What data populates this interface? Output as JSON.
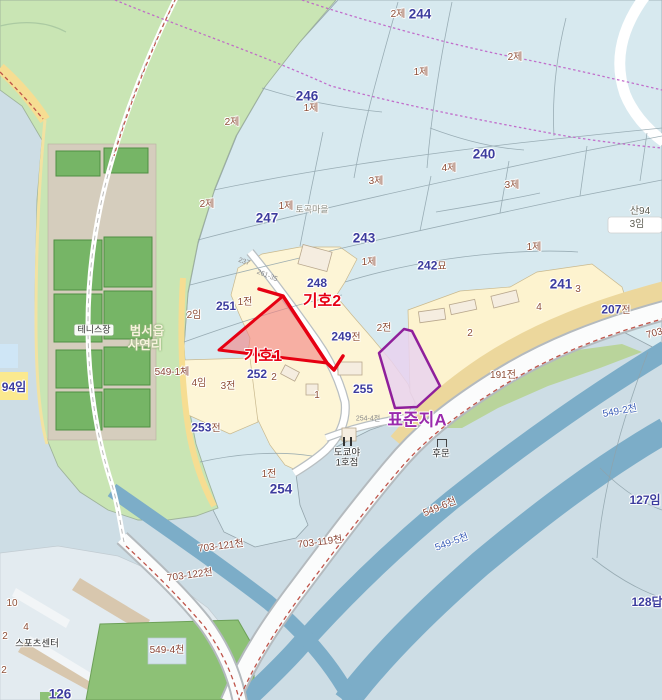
{
  "map": {
    "colors": {
      "base": "#cddde5",
      "cadastral_blue": "#d7e9ef",
      "forest_green": "#c9e5b4",
      "village_cream": "#fdf5d6",
      "river_blue": "#7cadc8",
      "road_yellow": "#f6dd92",
      "subject_red": "#e60012",
      "standard_purple": "#8f1f9b",
      "admin_dotted": "#bf62c8"
    },
    "highlights": {
      "subject1": {
        "label": "기호1",
        "stroke": "#e60012",
        "fill": "#f38080"
      },
      "subject2": {
        "label": "기호2",
        "stroke": "#e60012"
      },
      "standard": {
        "label": "표준지A",
        "stroke": "#8f1f9b",
        "fill": "#e9d2ef"
      }
    },
    "labels": [
      {
        "t": "2제",
        "x": 398,
        "y": 15,
        "c": "cat"
      },
      {
        "t": "244",
        "x": 420,
        "y": 14,
        "c": "pnum lg"
      },
      {
        "t": "2제",
        "x": 515,
        "y": 58,
        "c": "cat"
      },
      {
        "t": "246",
        "x": 307,
        "y": 96,
        "c": "pnum lg"
      },
      {
        "t": "1제",
        "x": 311,
        "y": 109,
        "c": "cat"
      },
      {
        "t": "2제",
        "x": 232,
        "y": 123,
        "c": "cat"
      },
      {
        "t": "1제",
        "x": 421,
        "y": 73,
        "c": "cat"
      },
      {
        "t": "240",
        "x": 484,
        "y": 154,
        "c": "pnum lg"
      },
      {
        "t": "4제",
        "x": 449,
        "y": 169,
        "c": "cat"
      },
      {
        "t": "3제",
        "x": 376,
        "y": 182,
        "c": "cat"
      },
      {
        "t": "3제",
        "x": 512,
        "y": 186,
        "c": "cat"
      },
      {
        "t": "2제",
        "x": 207,
        "y": 205,
        "c": "cat"
      },
      {
        "t": "1제",
        "x": 286,
        "y": 207,
        "c": "cat"
      },
      {
        "t": "토곡마을",
        "x": 312,
        "y": 210,
        "c": "place"
      },
      {
        "t": "247",
        "x": 267,
        "y": 218,
        "c": "pnum lg"
      },
      {
        "t": "243",
        "x": 364,
        "y": 238,
        "c": "pnum lg"
      },
      {
        "t": "1제",
        "x": 369,
        "y": 263,
        "c": "cat"
      },
      {
        "t": "산94",
        "x": 640,
        "y": 212,
        "c": "cat2"
      },
      {
        "t": "3임",
        "x": 637,
        "y": 225,
        "c": "cat2"
      },
      {
        "t": "248",
        "x": 317,
        "y": 283,
        "c": "pnum"
      },
      {
        "t": "242",
        "t2": "묘",
        "x": 432,
        "y": 266,
        "c": "pnum"
      },
      {
        "t": "1제",
        "x": 534,
        "y": 248,
        "c": "cat"
      },
      {
        "t": "241",
        "x": 561,
        "y": 284,
        "c": "pnum lg"
      },
      {
        "t": "3",
        "x": 578,
        "y": 290,
        "c": "num"
      },
      {
        "t": "4",
        "x": 539,
        "y": 308,
        "c": "num"
      },
      {
        "t": "207",
        "t2": "전",
        "x": 616,
        "y": 310,
        "c": "pnum"
      },
      {
        "t": "2",
        "x": 470,
        "y": 334,
        "c": "num"
      },
      {
        "t": "2전",
        "x": 384,
        "y": 329,
        "c": "cat"
      },
      {
        "t": "249",
        "t2": "전",
        "x": 346,
        "y": 337,
        "c": "pnum"
      },
      {
        "t": "251",
        "x": 226,
        "y": 306,
        "c": "pnum"
      },
      {
        "t": "1전",
        "x": 245,
        "y": 303,
        "c": "cat"
      },
      {
        "t": "2임",
        "x": 194,
        "y": 316,
        "c": "cat"
      },
      {
        "t": "252",
        "x": 257,
        "y": 374,
        "c": "pnum"
      },
      {
        "t": "2",
        "x": 274,
        "y": 378,
        "c": "num"
      },
      {
        "t": "4임",
        "x": 199,
        "y": 384,
        "c": "cat"
      },
      {
        "t": "3전",
        "x": 228,
        "y": 387,
        "c": "cat"
      },
      {
        "t": "255",
        "x": 363,
        "y": 389,
        "c": "pnum"
      },
      {
        "t": "1",
        "x": 317,
        "y": 396,
        "c": "num"
      },
      {
        "t": "191전",
        "x": 503,
        "y": 376,
        "c": "cat"
      },
      {
        "t": "253",
        "t2": "전",
        "x": 206,
        "y": 428,
        "c": "pnum"
      },
      {
        "t": "1전",
        "x": 269,
        "y": 475,
        "c": "cat"
      },
      {
        "t": "254",
        "x": 281,
        "y": 489,
        "c": "pnum lg"
      },
      {
        "t": "94임",
        "x": 14,
        "y": 387,
        "c": "pnum"
      },
      {
        "t": "127임",
        "x": 645,
        "y": 500,
        "c": "pnum"
      },
      {
        "t": "128답",
        "x": 647,
        "y": 602,
        "c": "pnum"
      },
      {
        "t": "126",
        "x": 60,
        "y": 694,
        "c": "pnum lg"
      },
      {
        "t": "테니스장",
        "x": 94,
        "y": 330,
        "c": "poibadge"
      },
      {
        "t": "범서읍",
        "x": 147,
        "y": 331,
        "c": "area"
      },
      {
        "t": "사연리",
        "x": 145,
        "y": 345,
        "c": "area"
      },
      {
        "t": "549-1체",
        "x": 172,
        "y": 373,
        "c": "roadlbl"
      },
      {
        "t": "도쿄야",
        "x": 347,
        "y": 453,
        "c": "poi"
      },
      {
        "t": "1호점",
        "x": 347,
        "y": 463,
        "c": "poi"
      },
      {
        "t": "후문",
        "x": 441,
        "y": 454,
        "c": "poi"
      },
      {
        "t": "스포츠센터",
        "x": 37,
        "y": 644,
        "c": "poi"
      },
      {
        "t": "10",
        "x": 12,
        "y": 604,
        "c": "num"
      },
      {
        "t": "4",
        "x": 26,
        "y": 628,
        "c": "num"
      },
      {
        "t": "2",
        "x": 5,
        "y": 637,
        "c": "num"
      },
      {
        "t": "2",
        "x": 4,
        "y": 671,
        "c": "num"
      },
      {
        "t": "703-119천",
        "x": 320,
        "y": 543,
        "c": "roadlbl",
        "r": -7
      },
      {
        "t": "703-121천",
        "x": 221,
        "y": 547,
        "c": "roadlbl",
        "r": -7
      },
      {
        "t": "703-122천",
        "x": 190,
        "y": 576,
        "c": "roadlbl",
        "r": -8
      },
      {
        "t": "549-4천",
        "x": 167,
        "y": 651,
        "c": "roadlbl"
      },
      {
        "t": "549-6천",
        "x": 440,
        "y": 508,
        "c": "roadlbl",
        "r": -22
      },
      {
        "t": "549-5천",
        "x": 452,
        "y": 543,
        "c": "riverlbl",
        "r": -20
      },
      {
        "t": "549-2천",
        "x": 620,
        "y": 412,
        "c": "riverlbl",
        "r": -10
      },
      {
        "t": "703-1",
        "x": 659,
        "y": 333,
        "c": "roadlbl",
        "r": -15
      },
      {
        "t": "237",
        "x": 244,
        "y": 262,
        "c": "tiny",
        "r": 18
      },
      {
        "t": "261-35",
        "x": 267,
        "y": 276,
        "c": "tiny",
        "r": 22
      },
      {
        "t": "254-4전",
        "x": 368,
        "y": 419,
        "c": "tiny"
      },
      {
        "t": "기호1",
        "x": 263,
        "y": 357,
        "c": "subject"
      },
      {
        "t": "기호2",
        "x": 322,
        "y": 302,
        "c": "subject"
      },
      {
        "t": "표준지A",
        "x": 417,
        "y": 420,
        "c": "standard"
      }
    ],
    "icons": [
      {
        "name": "restaurant-icon",
        "x": 347,
        "y": 441
      },
      {
        "name": "gate-icon",
        "x": 441,
        "y": 443
      }
    ]
  }
}
